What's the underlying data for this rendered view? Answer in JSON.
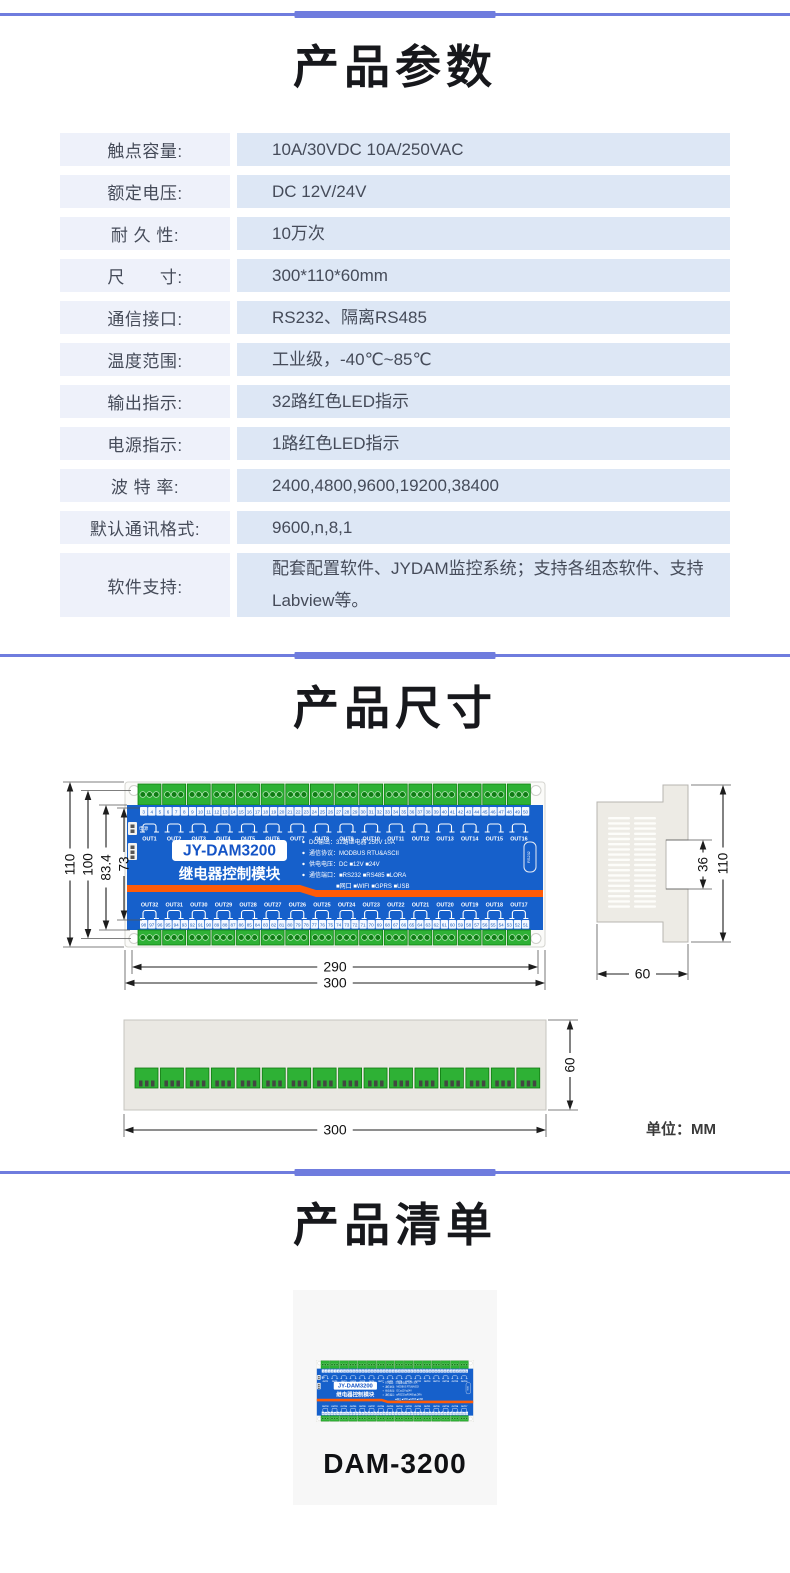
{
  "theme": {
    "accent": "#6f7cde",
    "table_label_bg": "#eef1fa",
    "table_value_bg": "#dde7f5",
    "module_blue": "#1660cb",
    "module_orange": "#ff5b07",
    "terminal_green": "#2eb135"
  },
  "params": {
    "title": "产品参数",
    "rows": [
      {
        "label": "触点容量:",
        "value": "10A/30VDC 10A/250VAC"
      },
      {
        "label": "额定电压:",
        "value": "DC 12V/24V"
      },
      {
        "label": "耐 久 性:",
        "value": "10万次"
      },
      {
        "label": "尺　　寸:",
        "value": "300*110*60mm"
      },
      {
        "label": "通信接口:",
        "value": "RS232、隔离RS485"
      },
      {
        "label": "温度范围:",
        "value": "工业级，-40℃~85℃"
      },
      {
        "label": "输出指示:",
        "value": "32路红色LED指示"
      },
      {
        "label": "电源指示:",
        "value": "1路红色LED指示"
      },
      {
        "label": "波 特 率:",
        "value": "2400,4800,9600,19200,38400"
      },
      {
        "label": "默认通讯格式:",
        "value": "9600,n,8,1"
      },
      {
        "label": "软件支持:",
        "value": "配套配置软件、JYDAM监控系统；支持各组态软件、支持Labview等。"
      }
    ]
  },
  "dimensions": {
    "title": "产品尺寸",
    "unit_note": "单位：MM",
    "front": {
      "left_dims": [
        "110",
        "100",
        "83.4",
        "73"
      ],
      "bottom_dims": [
        "290",
        "300"
      ]
    },
    "side": {
      "height_dim": "110",
      "notch_dim": "36",
      "depth_dim": "60"
    },
    "bottom": {
      "depth_dim": "60",
      "width_dim": "300"
    }
  },
  "module": {
    "model": "JY-DAM3200",
    "subtitle": "继电器控制模块",
    "power_label": "电源",
    "port_label": "RS232",
    "top_channels": [
      "OUT1",
      "OUT2",
      "OUT3",
      "OUT4",
      "OUT5",
      "OUT6",
      "OUT7",
      "OUT8",
      "OUT9",
      "OUT10",
      "OUT11",
      "OUT12",
      "OUT13",
      "OUT14",
      "OUT15",
      "OUT16"
    ],
    "bottom_channels": [
      "OUT32",
      "OUT31",
      "OUT30",
      "OUT29",
      "OUT28",
      "OUT27",
      "OUT26",
      "OUT25",
      "OUT24",
      "OUT23",
      "OUT22",
      "OUT21",
      "OUT20",
      "OUT19",
      "OUT18",
      "OUT17"
    ],
    "top_terminal_numbers": {
      "start": 3,
      "end": 50
    },
    "bottom_terminal_numbers": {
      "start": 98,
      "end": 51
    },
    "spec_lines": [
      {
        "text": "DO输出：32路继电器 250V 10A",
        "bullet": true,
        "indent": false
      },
      {
        "text": "通信协议：MODBUS RTU&ASCII",
        "bullet": true,
        "indent": false
      },
      {
        "text": "供电电压：DC ■12V ■24V",
        "bullet": true,
        "indent": false
      },
      {
        "text": "通信端口：■RS232 ■RS485 ■LORA",
        "bullet": true,
        "indent": false
      },
      {
        "text": "■网口  ■WIFI  ■GPRS  ■USB",
        "bullet": false,
        "indent": true
      }
    ]
  },
  "product_list": {
    "title": "产品清单",
    "item_name": "DAM-3200"
  }
}
